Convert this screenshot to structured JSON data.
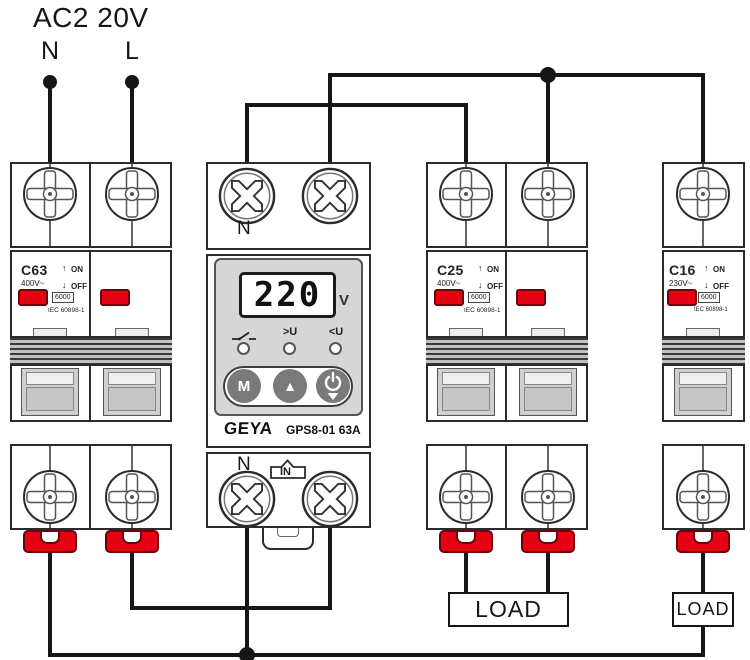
{
  "title": "AC2 20V",
  "source": {
    "neutral_label": "N",
    "line_label": "L"
  },
  "breakers": {
    "c63": {
      "model": "C63",
      "voltage": "400V~",
      "on_label": "ON",
      "off_label": "OFF",
      "breaking_capacity": "6000",
      "standard": "IEC 60898-1",
      "terminals": {
        "t1": "1",
        "t2": "2",
        "t3": "3",
        "t4": "4"
      }
    },
    "c25": {
      "model": "C25",
      "voltage": "400V~",
      "on_label": "ON",
      "off_label": "OFF",
      "breaking_capacity": "6000",
      "standard": "IEC 60898-1",
      "terminals": {
        "t1": "1",
        "t2": "2",
        "t3": "3",
        "t4": "4"
      }
    },
    "c16": {
      "model": "C16",
      "voltage": "230V~",
      "on_label": "ON",
      "off_label": "OFF",
      "breaking_capacity": "6000",
      "standard": "IEC 60898-1",
      "terminals": {
        "t1": "1",
        "t2": "2"
      }
    }
  },
  "protector": {
    "brand": "GEYA",
    "model": "GPS8-01 63A",
    "display": {
      "value": "220",
      "unit": "V"
    },
    "indicators": {
      "over_voltage": ">U",
      "under_voltage": "<U"
    },
    "buttons": {
      "mode": "M"
    },
    "terminals": {
      "top_neutral": "N",
      "bottom_neutral": "N",
      "input": "IN"
    }
  },
  "loads": {
    "load1_label": "LOAD",
    "load2_label": "LOAD"
  },
  "colors": {
    "handle_red": "#e60014",
    "wire_black": "#161616",
    "panel_gray": "#d6d6d6",
    "button_gray": "#7a7a7a",
    "display_bg": "#ffffff"
  }
}
